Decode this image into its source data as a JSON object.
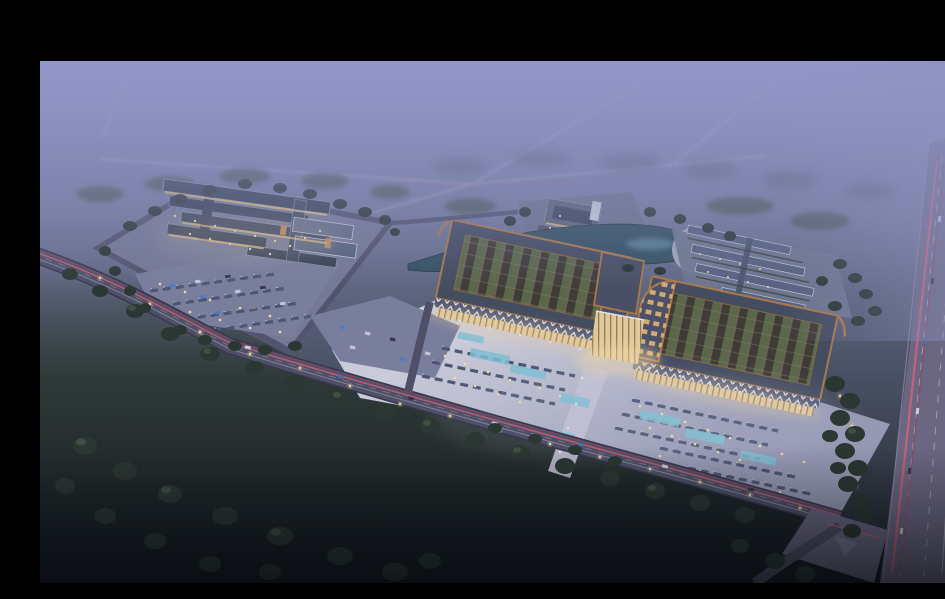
{
  "meta": {
    "kind": "architectural-aerial-render",
    "time_of_day": "dusk",
    "letterbox": "black bar across top",
    "description": "Aerial dusk rendering of a large trade-center campus: twin sweeping Chinese-style roof halls with open lattice courtyards and glowing glass fronts, a central lit entrance gate, a vast front plaza with parking rows and reflecting pools, a market-style complex with long gabled warm-lit buildings to the west, a pond with a circular fountain plaza and rows of outbuildings to the east, tree-lined access roads with red car light trails, and a multi-lane highway on the right fading into violet haze."
  },
  "colors": {
    "letterbox": "#000000",
    "sky_top": "#9397ca",
    "sky_mid": "#767d9e",
    "sky_low": "#4e5669",
    "ground_dark": "#161d1d",
    "field_green": "#263229",
    "tree_dark": "#27342b",
    "tree_mid": "#3c4e3b",
    "site_ground": "#767b96",
    "parking_ground": "#7a809c",
    "plaza_light": "#d3d4e0",
    "plaza_mid": "#9b9eb6",
    "roof_slate": "#424a5c",
    "roof_trim_copper": "#b07a42",
    "courtyard_green": "#5a6842",
    "lattice_dark": "#3c382f",
    "glass_warm": "#ecd09a",
    "light_warm": "#ffe2a0",
    "light_cool": "#e6eaf6",
    "water": "#30505f",
    "water_light": "#6fa3b5",
    "pool_cyan": "#7fc6d6",
    "road_gray": "#4e4f63",
    "highway_gray": "#6c6881",
    "lane_line": "#c8cbdb",
    "trail_red": "#df6077",
    "row_roof": "#57627d",
    "row_ridge": "#c3cce0",
    "fountain_tan": "#b2a489",
    "glow_amber": "#f7d9a0"
  }
}
